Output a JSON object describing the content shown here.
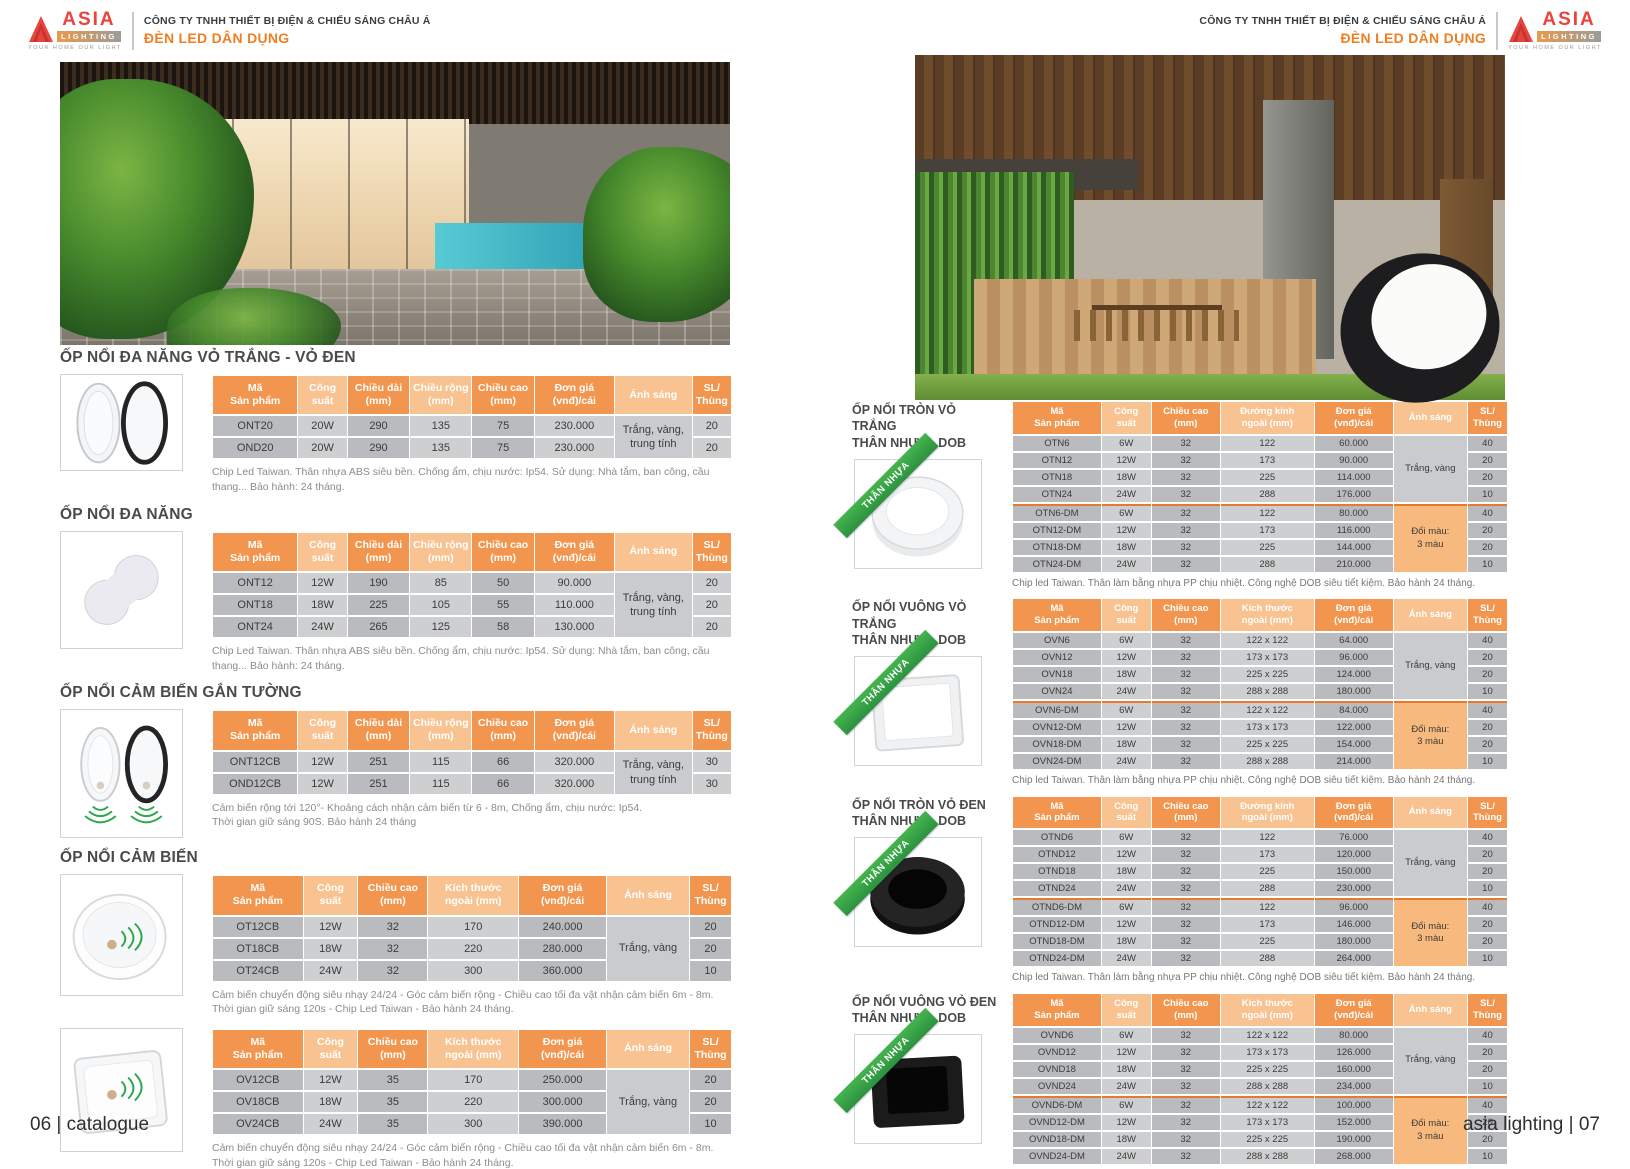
{
  "colors": {
    "accent_orange": "#F07E22",
    "table_header_dark": "#F2964F",
    "table_header_light": "#F8C291",
    "row_gray_dark": "#B9BBBE",
    "row_gray_light": "#CDCFD1",
    "light_cell_gray": "#C9CBCE",
    "change_color_cell_orange": "#F7B97E",
    "group_divider_orange": "#E8782A",
    "ribbon_green": "#2FA94C",
    "logo_red": "#E8433C"
  },
  "header": {
    "company": "CÔNG TY TNHH THIẾT BỊ ĐIỆN & CHIẾU SÁNG CHÂU Á",
    "department": "ĐÈN LED DÂN DỤNG"
  },
  "logo": {
    "brand": "ASIA",
    "sub": "LIGHTING",
    "tagline": "YOUR HOME OUR LIGHT"
  },
  "page_left": {
    "footer": "06 | catalogue",
    "sections": [
      {
        "title": "ỐP NỔI ĐA NĂNG VỎ TRẮNG - VỎ ĐEN",
        "table": {
          "headers": [
            "Mã\nSản phẩm",
            "Công\nsuất",
            "Chiều dài\n(mm)",
            "Chiều rộng\n(mm)",
            "Chiều cao\n(mm)",
            "Đơn giá\n(vnđ)/cái",
            "Ánh sáng",
            "SL/\nThùng"
          ],
          "shades": [
            "d",
            "l",
            "d",
            "l",
            "d",
            "d",
            "l",
            "d"
          ],
          "groups": [
            {
              "light": "Trắng, vàng,\ntrung tính",
              "style": "gray",
              "rows": [
                [
                  "ONT20",
                  "20W",
                  "290",
                  "135",
                  "75",
                  "230.000",
                  "20"
                ],
                [
                  "OND20",
                  "20W",
                  "290",
                  "135",
                  "75",
                  "230.000",
                  "20"
                ]
              ]
            }
          ]
        },
        "note": "Chip Led Taiwan. Thân nhựa ABS siêu bền. Chống ẩm, chịu nước: Ip54. Sử dụng: Nhà tắm, ban công, cầu thang... Bảo hành: 24 tháng."
      },
      {
        "title": "ỐP NỔI  ĐA NĂNG",
        "table": {
          "headers": [
            "Mã\nSản phẩm",
            "Công\nsuất",
            "Chiều dài\n(mm)",
            "Chiều rộng\n(mm)",
            "Chiều cao\n(mm)",
            "Đơn giá\n(vnđ)/cái",
            "Ánh sáng",
            "SL/\nThùng"
          ],
          "shades": [
            "d",
            "l",
            "d",
            "l",
            "d",
            "d",
            "l",
            "d"
          ],
          "groups": [
            {
              "light": "Trắng, vàng,\ntrung tính",
              "style": "gray",
              "rows": [
                [
                  "ONT12",
                  "12W",
                  "190",
                  "85",
                  "50",
                  "90.000",
                  "20"
                ],
                [
                  "ONT18",
                  "18W",
                  "225",
                  "105",
                  "55",
                  "110.000",
                  "20"
                ],
                [
                  "ONT24",
                  "24W",
                  "265",
                  "125",
                  "58",
                  "130.000",
                  "20"
                ]
              ]
            }
          ]
        },
        "note": "Chip Led Taiwan. Thân nhựa ABS siêu bền. Chống ẩm, chịu nước: Ip54. Sử dụng: Nhà tắm, ban công, cầu thang... Bảo hành: 24 tháng."
      },
      {
        "title": "ỐP NỔI CẢM BIẾN GẮN TƯỜNG",
        "table": {
          "headers": [
            "Mã\nSản phẩm",
            "Công\nsuất",
            "Chiều dài\n(mm)",
            "Chiều rộng\n(mm)",
            "Chiều cao\n(mm)",
            "Đơn giá\n(vnđ)/cái",
            "Ánh sáng",
            "SL/\nThùng"
          ],
          "shades": [
            "d",
            "l",
            "d",
            "l",
            "d",
            "d",
            "l",
            "d"
          ],
          "groups": [
            {
              "light": "Trắng, vàng,\ntrung tính",
              "style": "gray",
              "rows": [
                [
                  "ONT12CB",
                  "12W",
                  "251",
                  "115",
                  "66",
                  "320.000",
                  "30"
                ],
                [
                  "OND12CB",
                  "12W",
                  "251",
                  "115",
                  "66",
                  "320.000",
                  "30"
                ]
              ]
            }
          ]
        },
        "note": "Cảm biến rộng tới 120°- Khoảng cách nhận cảm biến từ 6 - 8m, Chống ẩm, chịu nước: Ip54.\nThời gian giữ sáng 90S. Bảo hành 24 tháng"
      },
      {
        "title": "ỐP NỔI CẢM BIẾN",
        "table": {
          "headers": [
            "Mã\nSản phẩm",
            "Công\nsuất",
            "Chiều cao\n(mm)",
            "Kích thước\nngoài (mm)",
            "Đơn giá\n(vnđ)/cái",
            "Ánh sáng",
            "SL/\nThùng"
          ],
          "shades": [
            "d",
            "l",
            "d",
            "l",
            "d",
            "l",
            "d"
          ],
          "groups": [
            {
              "light": "Trắng, vàng",
              "style": "gray",
              "rows": [
                [
                  "OT12CB",
                  "12W",
                  "32",
                  "170",
                  "240.000",
                  "20"
                ],
                [
                  "OT18CB",
                  "18W",
                  "32",
                  "220",
                  "280.000",
                  "20"
                ],
                [
                  "OT24CB",
                  "24W",
                  "32",
                  "300",
                  "360.000",
                  "10"
                ]
              ]
            }
          ]
        },
        "note": "Cảm biến chuyển động siêu nhạy 24/24 - Góc cảm biến rộng -  Chiều cao tối đa vật nhận cảm biến 6m - 8m.\nThời gian giữ sáng 120s - Chip Led Taiwan - Bảo hành 24 tháng."
      },
      {
        "title": "",
        "table": {
          "headers": [
            "Mã\nSản phẩm",
            "Công\nsuất",
            "Chiều cao\n(mm)",
            "Kích thước\nngoài (mm)",
            "Đơn giá\n(vnđ)/cái",
            "Ánh sáng",
            "SL/\nThùng"
          ],
          "shades": [
            "d",
            "l",
            "d",
            "l",
            "d",
            "l",
            "d"
          ],
          "groups": [
            {
              "light": "Trắng, vàng",
              "style": "gray",
              "rows": [
                [
                  "OV12CB",
                  "12W",
                  "35",
                  "170",
                  "250.000",
                  "20"
                ],
                [
                  "OV18CB",
                  "18W",
                  "35",
                  "220",
                  "300.000",
                  "20"
                ],
                [
                  "OV24CB",
                  "24W",
                  "35",
                  "300",
                  "390.000",
                  "10"
                ]
              ]
            }
          ]
        },
        "note": "Cảm biến chuyển động siêu nhạy 24/24 - Góc cảm biến rộng -  Chiều cao tối đa vật nhận cảm biến 6m - 8m.\nThời gian giữ sáng 120s - Chip Led Taiwan - Bảo hành 24 tháng."
      }
    ]
  },
  "page_right": {
    "footer": "asia lighting | 07",
    "sections": [
      {
        "title": "ỐP NỔI TRÒN VỎ TRẮNG\nTHÂN NHỰA - DOB",
        "ribbon": "THÂN NHỰA",
        "table": {
          "headers": [
            "Mã\nSản phẩm",
            "Công\nsuất",
            "Chiều cao\n(mm)",
            "Đường kính\nngoài (mm)",
            "Đơn giá\n(vnđ)/cái",
            "Ánh sáng",
            "SL/\nThùng"
          ],
          "shades": [
            "d",
            "l",
            "d",
            "l",
            "d",
            "l",
            "d"
          ],
          "groups": [
            {
              "light": "Trắng, vàng",
              "style": "gray",
              "rows": [
                [
                  "OTN6",
                  "6W",
                  "32",
                  "122",
                  "60.000",
                  "40"
                ],
                [
                  "OTN12",
                  "12W",
                  "32",
                  "173",
                  "90.000",
                  "20"
                ],
                [
                  "OTN18",
                  "18W",
                  "32",
                  "225",
                  "114.000",
                  "20"
                ],
                [
                  "OTN24",
                  "24W",
                  "32",
                  "288",
                  "176.000",
                  "10"
                ]
              ]
            },
            {
              "light": "Đổi màu:\n3 màu",
              "style": "orange",
              "rows": [
                [
                  "OTN6-DM",
                  "6W",
                  "32",
                  "122",
                  "80.000",
                  "40"
                ],
                [
                  "OTN12-DM",
                  "12W",
                  "32",
                  "173",
                  "116.000",
                  "20"
                ],
                [
                  "OTN18-DM",
                  "18W",
                  "32",
                  "225",
                  "144.000",
                  "20"
                ],
                [
                  "OTN24-DM",
                  "24W",
                  "32",
                  "288",
                  "210.000",
                  "10"
                ]
              ]
            }
          ]
        },
        "note": "Chip led Taiwan. Thân làm bằng nhựa PP chịu nhiệt. Công nghệ DOB siêu tiết kiệm. Bảo hành 24 tháng."
      },
      {
        "title": "ỐP NỔI VUÔNG VỎ TRẮNG\nTHÂN NHỰA - DOB",
        "ribbon": "THÂN NHỰA",
        "table": {
          "headers": [
            "Mã\nSản phẩm",
            "Công\nsuất",
            "Chiều cao\n(mm)",
            "Kích thước\nngoài (mm)",
            "Đơn giá\n(vnđ)/cái",
            "Ánh sáng",
            "SL/\nThùng"
          ],
          "shades": [
            "d",
            "l",
            "d",
            "l",
            "d",
            "l",
            "d"
          ],
          "groups": [
            {
              "light": "Trắng, vàng",
              "style": "gray",
              "rows": [
                [
                  "OVN6",
                  "6W",
                  "32",
                  "122 x 122",
                  "64.000",
                  "40"
                ],
                [
                  "OVN12",
                  "12W",
                  "32",
                  "173 x 173",
                  "96.000",
                  "20"
                ],
                [
                  "OVN18",
                  "18W",
                  "32",
                  "225 x 225",
                  "124.000",
                  "20"
                ],
                [
                  "OVN24",
                  "24W",
                  "32",
                  "288 x 288",
                  "180.000",
                  "10"
                ]
              ]
            },
            {
              "light": "Đổi màu:\n3 màu",
              "style": "orange",
              "rows": [
                [
                  "OVN6-DM",
                  "6W",
                  "32",
                  "122 x 122",
                  "84.000",
                  "40"
                ],
                [
                  "OVN12-DM",
                  "12W",
                  "32",
                  "173 x 173",
                  "122.000",
                  "20"
                ],
                [
                  "OVN18-DM",
                  "18W",
                  "32",
                  "225 x 225",
                  "154.000",
                  "20"
                ],
                [
                  "OVN24-DM",
                  "24W",
                  "32",
                  "288 x 288",
                  "214.000",
                  "10"
                ]
              ]
            }
          ]
        },
        "note": "Chip led Taiwan. Thân làm bằng nhựa PP chịu nhiệt. Công nghệ DOB siêu tiết kiệm. Bảo hành 24 tháng."
      },
      {
        "title": "ỐP NỔI TRÒN  VỎ ĐEN\nTHÂN NHỰA - DOB",
        "ribbon": "THÂN NHỰA",
        "table": {
          "headers": [
            "Mã\nSản phẩm",
            "Công\nsuất",
            "Chiều cao\n(mm)",
            "Đường kính\nngoài (mm)",
            "Đơn giá\n(vnđ)/cái",
            "Ánh sáng",
            "SL/\nThùng"
          ],
          "shades": [
            "d",
            "l",
            "d",
            "l",
            "d",
            "l",
            "d"
          ],
          "groups": [
            {
              "light": "Trắng, vàng",
              "style": "gray",
              "rows": [
                [
                  "OTND6",
                  "6W",
                  "32",
                  "122",
                  "76.000",
                  "40"
                ],
                [
                  "OTND12",
                  "12W",
                  "32",
                  "173",
                  "120.000",
                  "20"
                ],
                [
                  "OTND18",
                  "18W",
                  "32",
                  "225",
                  "150.000",
                  "20"
                ],
                [
                  "OTND24",
                  "24W",
                  "32",
                  "288",
                  "230.000",
                  "10"
                ]
              ]
            },
            {
              "light": "Đổi màu:\n3 màu",
              "style": "orange",
              "rows": [
                [
                  "OTND6-DM",
                  "6W",
                  "32",
                  "122",
                  "96.000",
                  "40"
                ],
                [
                  "OTND12-DM",
                  "12W",
                  "32",
                  "173",
                  "146.000",
                  "20"
                ],
                [
                  "OTND18-DM",
                  "18W",
                  "32",
                  "225",
                  "180.000",
                  "20"
                ],
                [
                  "OTND24-DM",
                  "24W",
                  "32",
                  "288",
                  "264.000",
                  "10"
                ]
              ]
            }
          ]
        },
        "note": "Chip led Taiwan. Thân làm bằng nhựa PP chịu nhiệt. Công nghệ DOB siêu tiết kiệm. Bảo hành 24 tháng."
      },
      {
        "title": "ỐP NỔI  VUÔNG VỎ ĐEN\nTHÂN NHỰA - DOB",
        "ribbon": "THÂN NHỰA",
        "table": {
          "headers": [
            "Mã\nSản phẩm",
            "Công\nsuất",
            "Chiều cao\n(mm)",
            "Kích thước\nngoài (mm)",
            "Đơn giá\n(vnđ)/cái",
            "Ánh sáng",
            "SL/\nThùng"
          ],
          "shades": [
            "d",
            "l",
            "d",
            "l",
            "d",
            "l",
            "d"
          ],
          "groups": [
            {
              "light": "Trắng, vàng",
              "style": "gray",
              "rows": [
                [
                  "OVND6",
                  "6W",
                  "32",
                  "122 x 122",
                  "80.000",
                  "40"
                ],
                [
                  "OVND12",
                  "12W",
                  "32",
                  "173 x 173",
                  "126.000",
                  "20"
                ],
                [
                  "OVND18",
                  "18W",
                  "32",
                  "225 x 225",
                  "160.000",
                  "20"
                ],
                [
                  "OVND24",
                  "24W",
                  "32",
                  "288 x 288",
                  "234.000",
                  "10"
                ]
              ]
            },
            {
              "light": "Đổi màu:\n3 màu",
              "style": "orange",
              "rows": [
                [
                  "OVND6-DM",
                  "6W",
                  "32",
                  "122 x 122",
                  "100.000",
                  "40"
                ],
                [
                  "OVND12-DM",
                  "12W",
                  "32",
                  "173 x 173",
                  "152.000",
                  "20"
                ],
                [
                  "OVND18-DM",
                  "18W",
                  "32",
                  "225 x 225",
                  "190.000",
                  "20"
                ],
                [
                  "OVND24-DM",
                  "24W",
                  "32",
                  "288 x 288",
                  "268.000",
                  "10"
                ]
              ]
            }
          ]
        },
        "note": "Chip led Taiwan. Thân làm bằng nhựa PP chịu nhiệt. Công nghệ DOB siêu tiết kiệm. Bảo hành 24 tháng."
      }
    ]
  }
}
